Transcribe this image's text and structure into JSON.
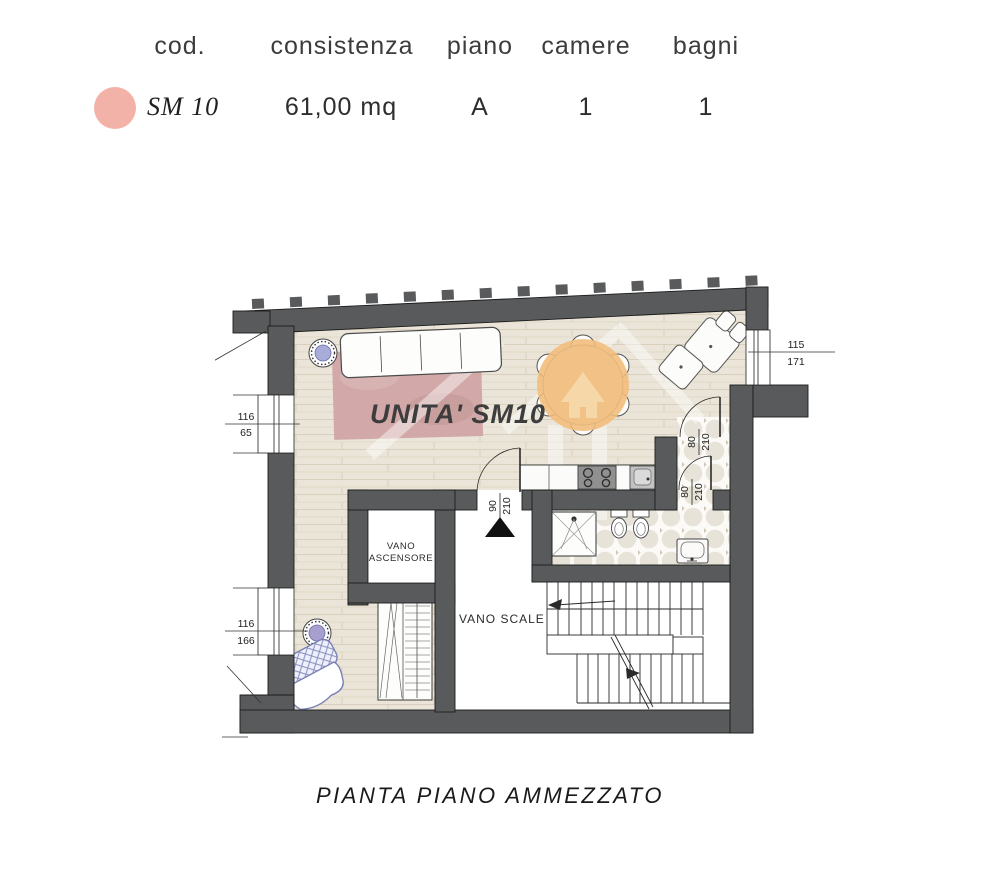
{
  "header": {
    "columns": [
      "cod.",
      "consistenza",
      "piano",
      "camere",
      "bagni"
    ],
    "unit": {
      "code": "SM 10",
      "consistenza": "61,00 mq",
      "piano": "A",
      "camere": "1",
      "bagni": "1"
    },
    "marker_color": "#f3b2a7"
  },
  "plan": {
    "unit_label": "UNITA' SM10",
    "rooms": {
      "elevator_line1": "VANO",
      "elevator_line2": "ASCENSORE",
      "stairs": "VANO SCALE"
    },
    "dims": {
      "win_left_top_w": "116",
      "win_left_top_h": "65",
      "win_left_bottom_w": "116",
      "win_left_bottom_h": "166",
      "win_right_w": "115",
      "win_right_h": "171",
      "door_entry_w": "90",
      "door_entry_h": "210",
      "door_hall_w": "80",
      "door_hall_h": "210",
      "door_bath_w": "80",
      "door_bath_h": "210"
    },
    "colors": {
      "wall": "#595a5c",
      "floor": "#eae5d8",
      "rug": "#cfa4a4",
      "watermark": "#f1bc7a",
      "accent_blue": "#a8acd8"
    }
  },
  "caption": "PIANTA PIANO AMMEZZATO"
}
